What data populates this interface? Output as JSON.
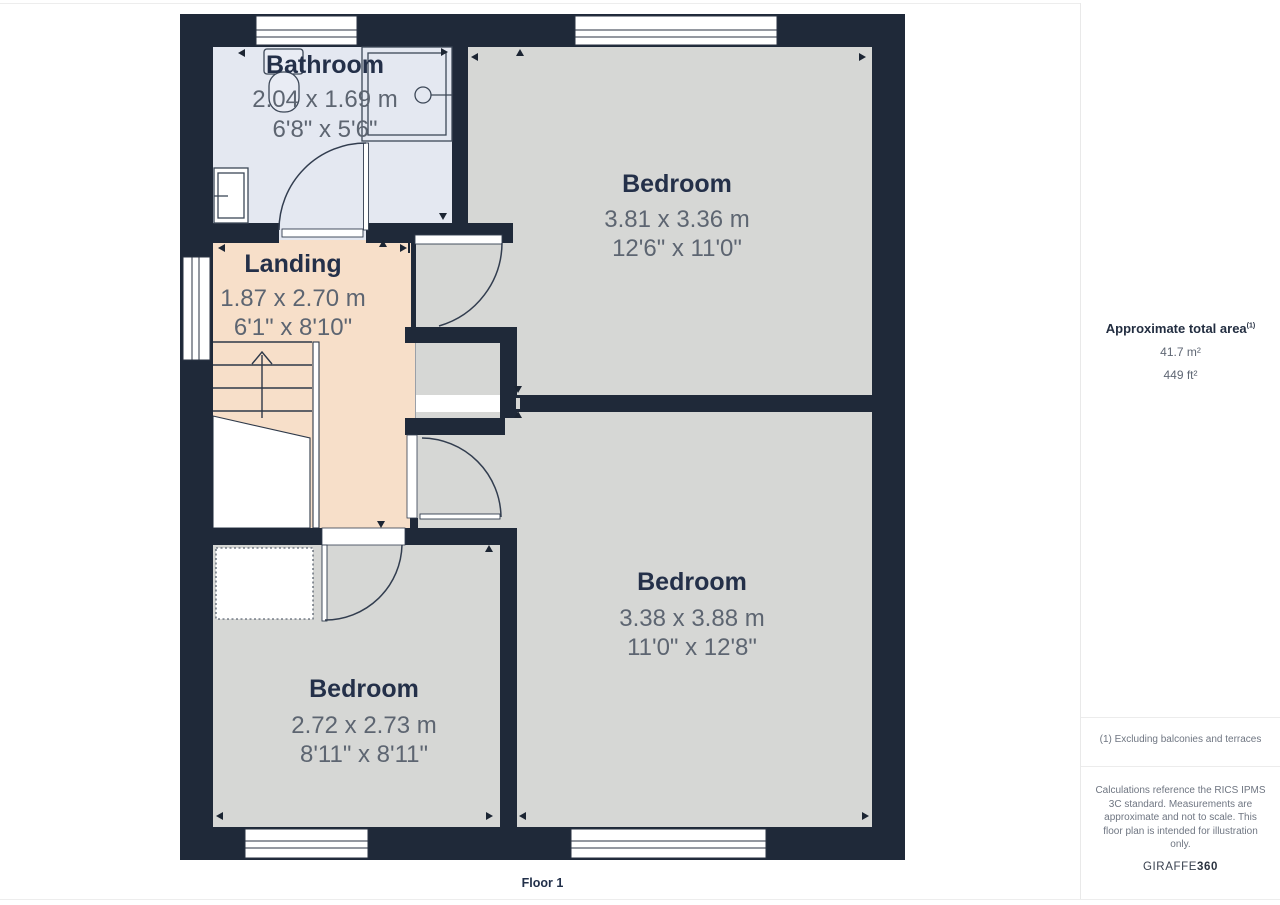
{
  "page": {
    "floor_label": "Floor 1"
  },
  "rooms": [
    {
      "id": "bathroom",
      "name": "Bathroom",
      "dims_m": "2.04 x 1.69 m",
      "dims_ft": "6'8\" x 5'6\""
    },
    {
      "id": "landing",
      "name": "Landing",
      "dims_m": "1.87 x 2.70 m",
      "dims_ft": "6'1\" x 8'10\""
    },
    {
      "id": "bedroom-top-right",
      "name": "Bedroom",
      "dims_m": "3.81 x 3.36 m",
      "dims_ft": "12'6\" x 11'0\""
    },
    {
      "id": "bedroom-bottom-right",
      "name": "Bedroom",
      "dims_m": "3.38 x 3.88 m",
      "dims_ft": "11'0\" x 12'8\""
    },
    {
      "id": "bedroom-bottom-left",
      "name": "Bedroom",
      "dims_m": "2.72 x 2.73 m",
      "dims_ft": "8'11\" x 8'11\""
    }
  ],
  "sidebar": {
    "area_title": "Approximate total area",
    "area_footnote_marker": "(1)",
    "area_value_metric": "41.7 m²",
    "area_value_imperial": "449 ft²",
    "footnote": "(1) Excluding balconies and terraces",
    "disclaimer": "Calculations reference the RICS IPMS 3C standard. Measurements are approximate and not to scale. This floor plan is intended for illustration only.",
    "brand_name": "GIRAFFE",
    "brand_suffix": "360"
  },
  "colors": {
    "wall": "#1f2939",
    "bedroom_fill": "#d6d7d5",
    "bathroom_fill": "#e4e8f1",
    "landing_fill": "#f7dfc9",
    "room_name_text": "#243049",
    "dimension_text": "#5d6571"
  }
}
